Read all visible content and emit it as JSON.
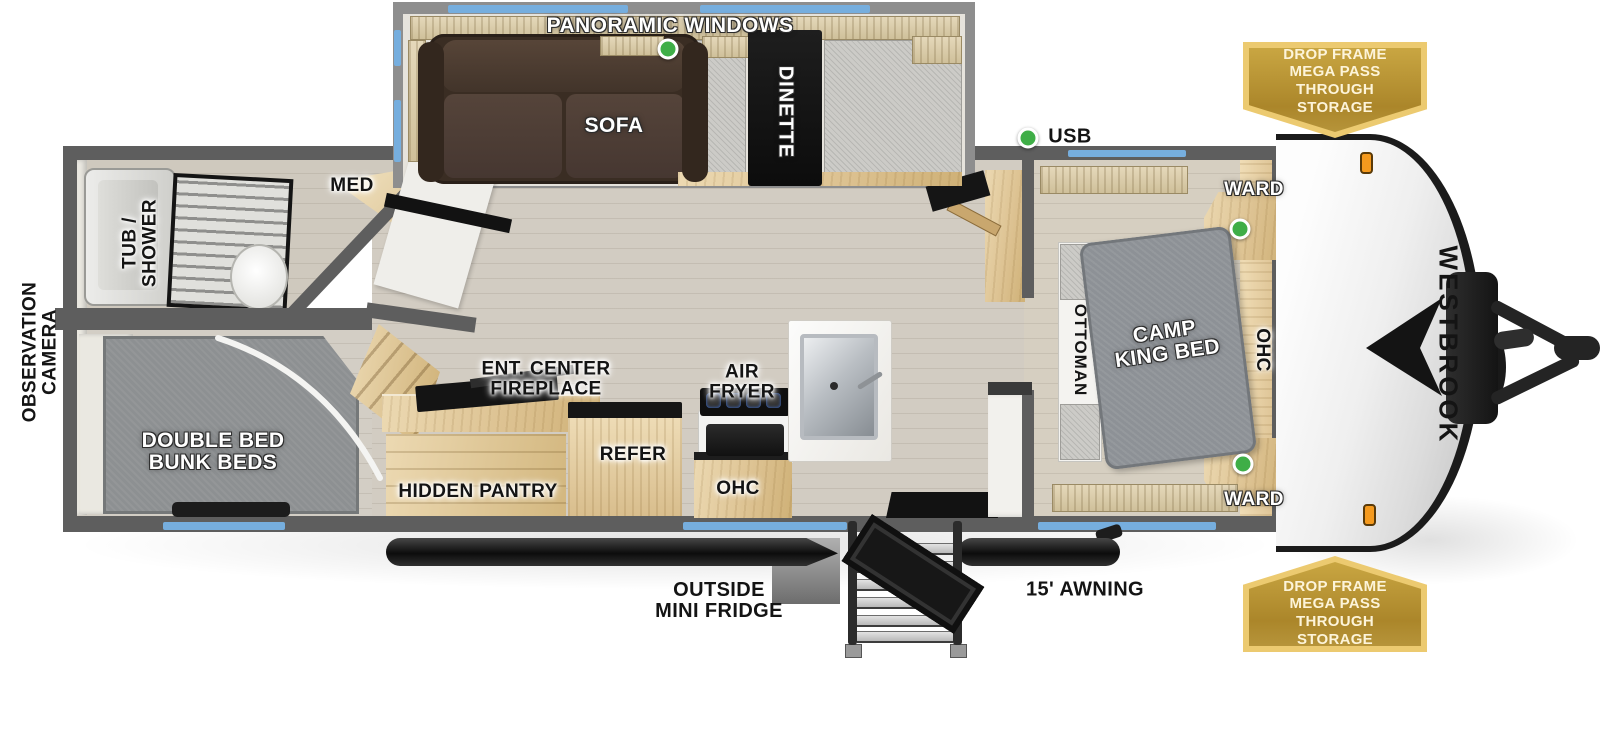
{
  "brand": {
    "name": "WESTBROOK"
  },
  "colors": {
    "accent_blue": "#76aede",
    "indicator_green": "#3fae47",
    "badge_gold_outer": "#ecca70",
    "badge_gold_inner": "#ab862a",
    "wall_gray": "#5e5e5e",
    "cabinet_wood": "#dcc190",
    "sofa_brown": "#46382c",
    "bed_gray": "#8d9196"
  },
  "badges": {
    "drop_frame_storage": "DROP FRAME\nMEGA PASS THROUGH\nSTORAGE"
  },
  "exterior": {
    "panoramic_windows": "PANORAMIC WINDOWS",
    "usb": "USB",
    "observation_camera": "OBSERVATION\nCAMERA",
    "outside_mini_fridge": "OUTSIDE\nMINI FRIDGE",
    "awning": "15' AWNING"
  },
  "bathroom": {
    "tub_shower": "TUB /\nSHOWER",
    "med_cabinet": "MED"
  },
  "bunk_room": {
    "bunk_label": "DOUBLE BED\nBUNK BEDS"
  },
  "living_area": {
    "sofa": "SOFA",
    "dinette": "DINETTE",
    "ent_center": "ENT. CENTER\nFIREPLACE",
    "hidden_pantry": "HIDDEN PANTRY",
    "refrigerator": "REFER",
    "overhead_cabinet": "OHC",
    "air_fryer": "AIR\nFRYER"
  },
  "bedroom": {
    "bed": "CAMP\nKING BED",
    "ottoman": "OTTOMAN",
    "overhead_cabinet": "OHC",
    "wardrobe_top": "WARD",
    "wardrobe_bottom": "WARD"
  }
}
